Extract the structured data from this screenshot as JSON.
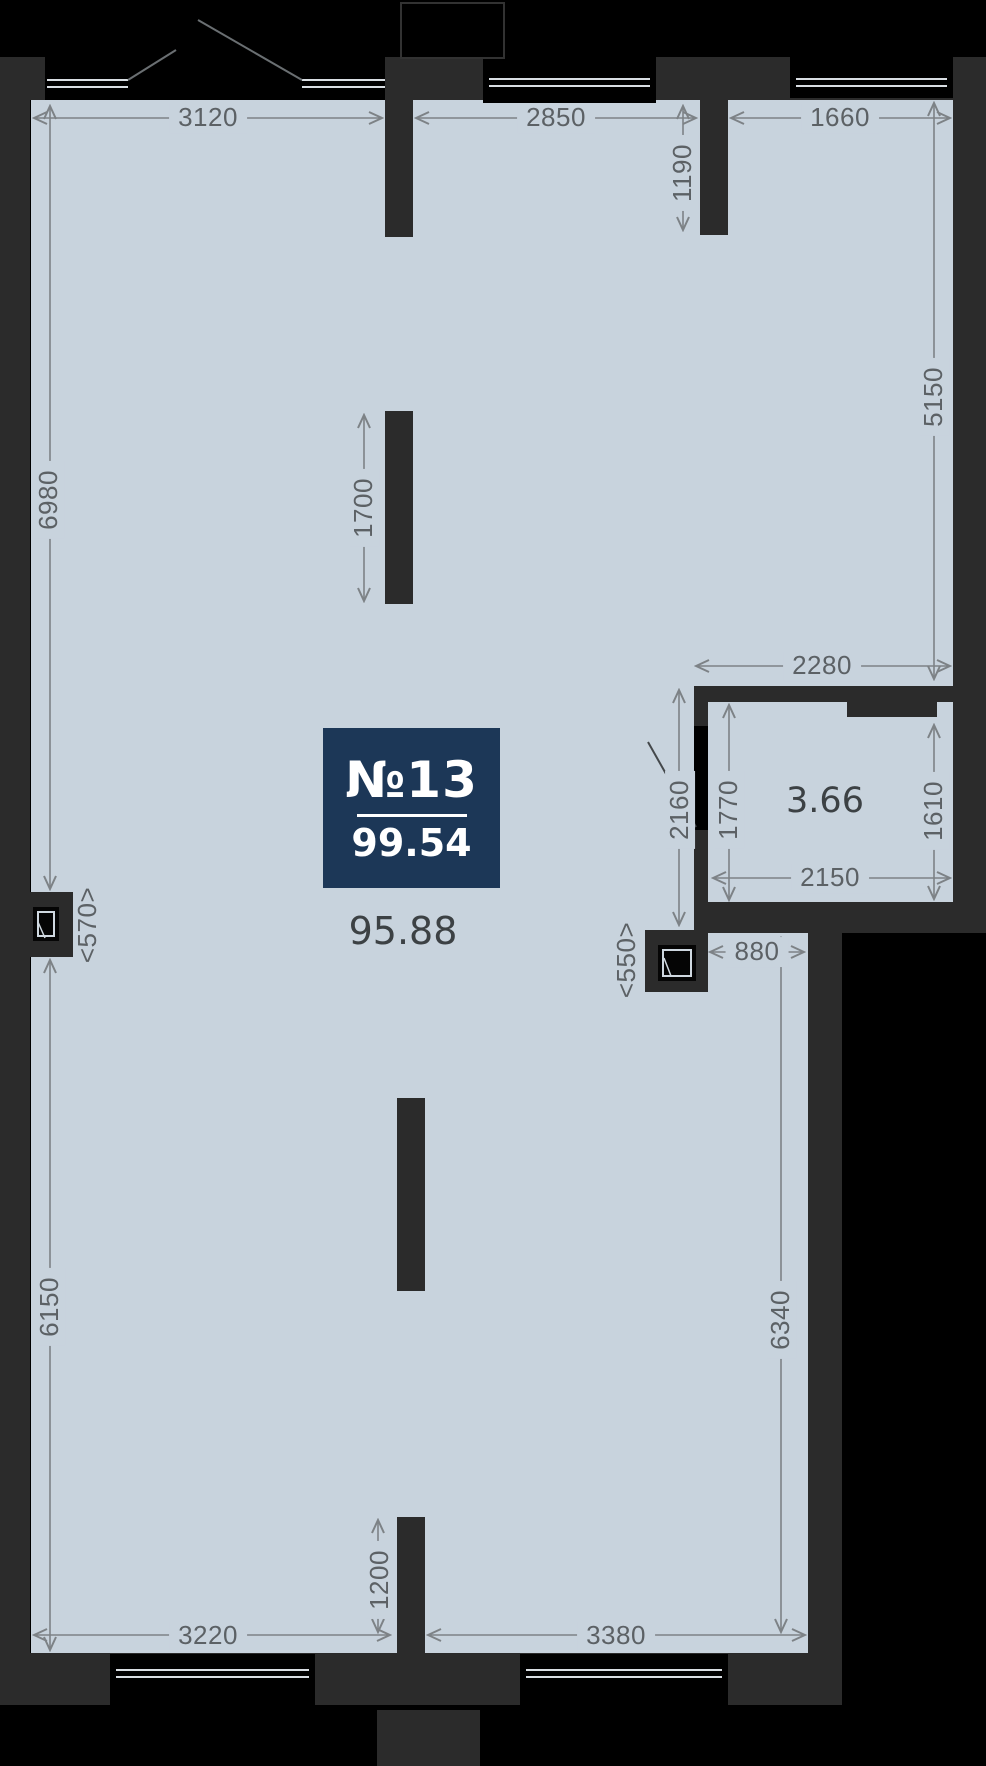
{
  "unit": {
    "badge_number": "№13",
    "badge_total_area": "99.54",
    "main_room_area": "95.88",
    "bathroom_area": "3.66"
  },
  "dims": {
    "d3120": "3120",
    "d2850": "2850",
    "d1660": "1660",
    "d1190": "1190",
    "d5150": "5150",
    "d6980": "6980",
    "d1700": "1700",
    "d2280": "2280",
    "d2160": "2160",
    "d1770": "1770",
    "d1610": "1610",
    "d2150": "2150",
    "d570": "<570>",
    "d550": "<550>",
    "d880": "880",
    "d6150": "6150",
    "d6340": "6340",
    "d1200": "1200",
    "d3220": "3220",
    "d3380": "3380"
  },
  "colors": {
    "background": "#000000",
    "wall": "#2b2b2b",
    "floor": "#c8d3dd",
    "badge": "#1c3757",
    "dimension_text": "#5c6165",
    "area_text": "#3c4144",
    "window_sill": "#d9dee3"
  }
}
